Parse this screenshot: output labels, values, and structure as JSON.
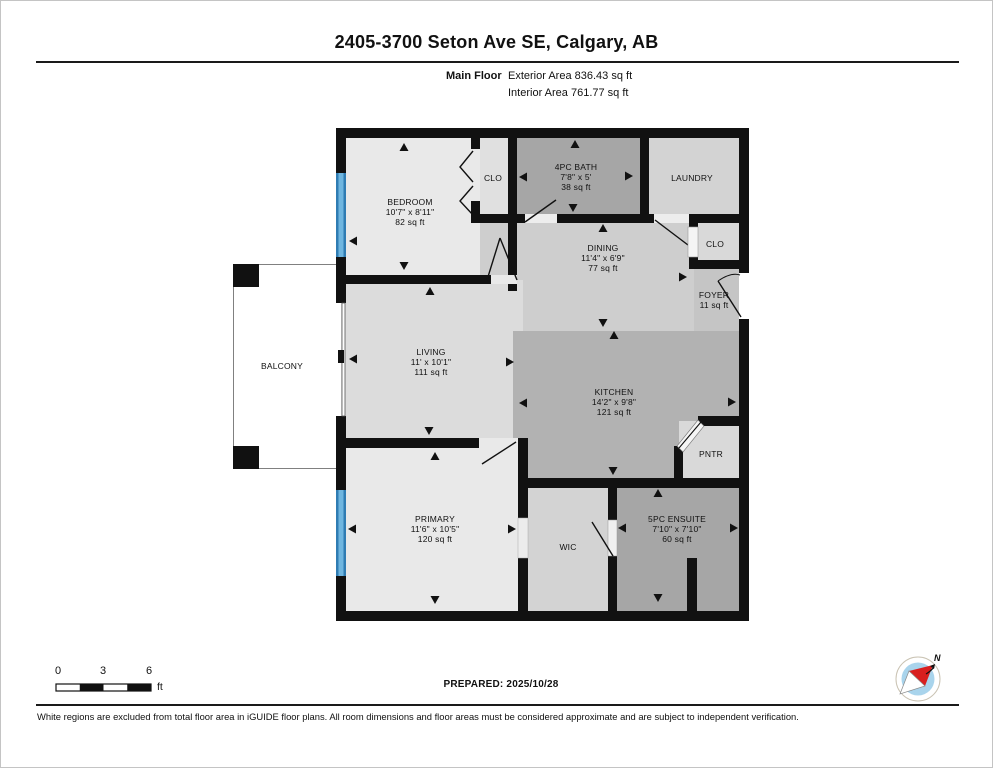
{
  "header": {
    "title": "2405-3700 Seton Ave SE, Calgary, AB",
    "floor_label": "Main Floor",
    "exterior_area": "Exterior Area 836.43 sq ft",
    "interior_area": "Interior Area 761.77 sq ft"
  },
  "rooms": [
    {
      "id": "bedroom",
      "name": "BEDROOM",
      "dims": "10'7\" x 8'11\"",
      "area": "82 sq ft",
      "x": 409,
      "y": 211
    },
    {
      "id": "closet-bedroom",
      "name": "CLO",
      "dims": "",
      "area": "",
      "x": 492,
      "y": 177
    },
    {
      "id": "bath",
      "name": "4PC BATH",
      "dims": "7'8\" x 5'",
      "area": "38 sq ft",
      "x": 575,
      "y": 176
    },
    {
      "id": "laundry",
      "name": "LAUNDRY",
      "dims": "",
      "area": "",
      "x": 691,
      "y": 177
    },
    {
      "id": "dining",
      "name": "DINING",
      "dims": "11'4\" x 6'9\"",
      "area": "77 sq ft",
      "x": 602,
      "y": 257
    },
    {
      "id": "closet-foyer",
      "name": "CLO",
      "dims": "",
      "area": "",
      "x": 714,
      "y": 243
    },
    {
      "id": "foyer",
      "name": "FOYER",
      "dims": "",
      "area": "11 sq ft",
      "x": 713,
      "y": 299
    },
    {
      "id": "living",
      "name": "LIVING",
      "dims": "11' x 10'1\"",
      "area": "111 sq ft",
      "x": 430,
      "y": 361
    },
    {
      "id": "kitchen",
      "name": "KITCHEN",
      "dims": "14'2\" x 9'8\"",
      "area": "121 sq ft",
      "x": 613,
      "y": 401
    },
    {
      "id": "pantry",
      "name": "PNTR",
      "dims": "",
      "area": "",
      "x": 710,
      "y": 453
    },
    {
      "id": "primary",
      "name": "PRIMARY",
      "dims": "11'6\" x 10'5\"",
      "area": "120 sq ft",
      "x": 434,
      "y": 528
    },
    {
      "id": "wic",
      "name": "WIC",
      "dims": "",
      "area": "",
      "x": 567,
      "y": 546
    },
    {
      "id": "ensuite",
      "name": "5PC ENSUITE",
      "dims": "7'10\" x 7'10\"",
      "area": "60 sq ft",
      "x": 676,
      "y": 528
    },
    {
      "id": "balcony",
      "name": "BALCONY",
      "dims": "",
      "area": "",
      "x": 281,
      "y": 365
    }
  ],
  "scale_bar": {
    "ticks": [
      "0",
      "3",
      "6"
    ],
    "unit": "ft"
  },
  "compass": {
    "north_label": "N"
  },
  "footer": {
    "prepared": "PREPARED: 2025/10/28",
    "disclaimer": "White regions are excluded from total floor area in iGUIDE floor plans. All room dimensions and floor areas must be considered approximate and are subject to independent verification."
  },
  "colors": {
    "wall": "#111111",
    "window": "#5aabd9",
    "room_lightest": "#e9e9e9",
    "room_light": "#dcdcdc",
    "room_medium": "#cecece",
    "kitchen": "#b2b2b2",
    "room_dark": "#a6a6a6",
    "foyer": "#c5c5c5"
  }
}
